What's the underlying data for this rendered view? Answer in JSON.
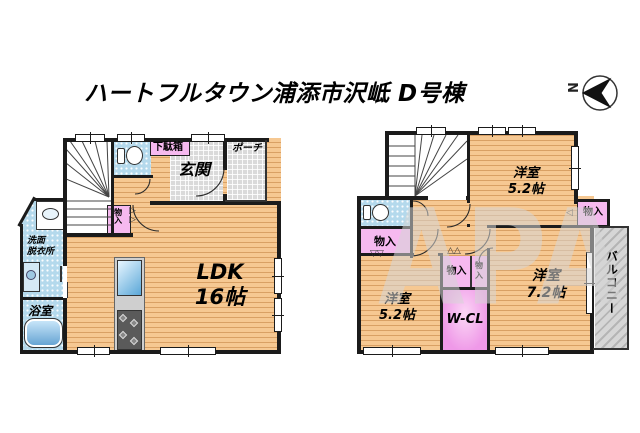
{
  "title": "ハートフルタウン浦添市沢岻 D号棟",
  "compass": {
    "label": "N"
  },
  "watermark": "APA",
  "colors": {
    "wall": "#1b1b1b",
    "wood_floor": "#f6c892",
    "tile_floor": "#dadada",
    "wet_floor": "#b4d9ec",
    "closet_pink": "#f6b9ef",
    "wcl_pink": "#ef99e8",
    "balcony_gray": "#c6c6c6"
  },
  "floor1": {
    "rooms": {
      "entrance": "玄関",
      "porch": "ポーチ",
      "shoe_cabinet": "下駄箱",
      "closet": "物入",
      "ldk": [
        "LDK",
        "16帖"
      ],
      "washroom": [
        "洗面",
        "脱衣所"
      ],
      "bathroom": "浴室"
    }
  },
  "floor2": {
    "rooms": {
      "bedroom_top": [
        "洋室",
        "5.2帖"
      ],
      "bedroom_left": [
        "洋室",
        "5.2帖"
      ],
      "bedroom_right": [
        "洋室",
        "7.2帖"
      ],
      "walk_in_closet": "W-CL",
      "closet_left": "物入",
      "closet_mid": "物入",
      "closet_small": [
        "物",
        "入"
      ],
      "closet_right": "物入",
      "balcony": "バルコニー"
    }
  }
}
